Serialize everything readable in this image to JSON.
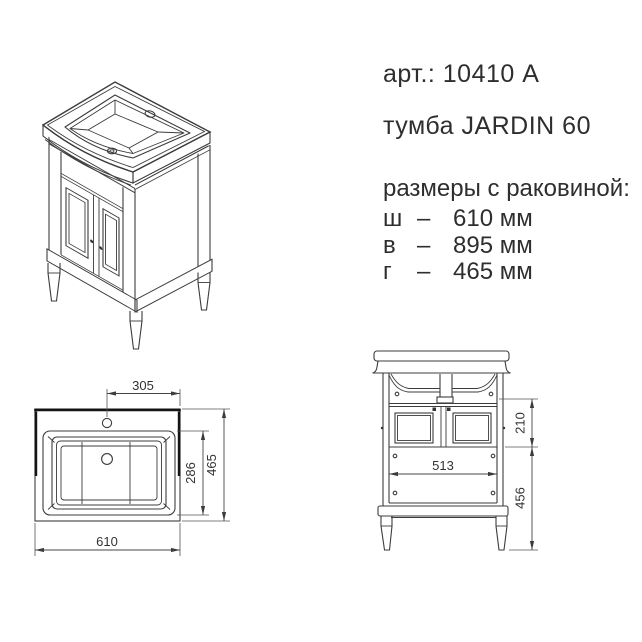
{
  "product": {
    "art_label": "арт.: 10410 A",
    "name": "тумба JARDIN 60",
    "dims_title": "размеры с раковиной:",
    "dims": [
      {
        "key": "ш",
        "dash": "–",
        "value": "610 мм"
      },
      {
        "key": "в",
        "dash": "–",
        "value": "895 мм"
      },
      {
        "key": "г",
        "dash": "–",
        "value": "465 мм"
      }
    ]
  },
  "top_view": {
    "faucet_to_edge": "305",
    "basin_depth": "286",
    "overall_depth": "465",
    "overall_width": "610"
  },
  "front_view": {
    "upper_section_height": "210",
    "interior_width": "513",
    "lower_section_height": "456"
  },
  "colors": {
    "line": "#3c3c3c",
    "text": "#2e2e2e",
    "background": "#ffffff"
  }
}
